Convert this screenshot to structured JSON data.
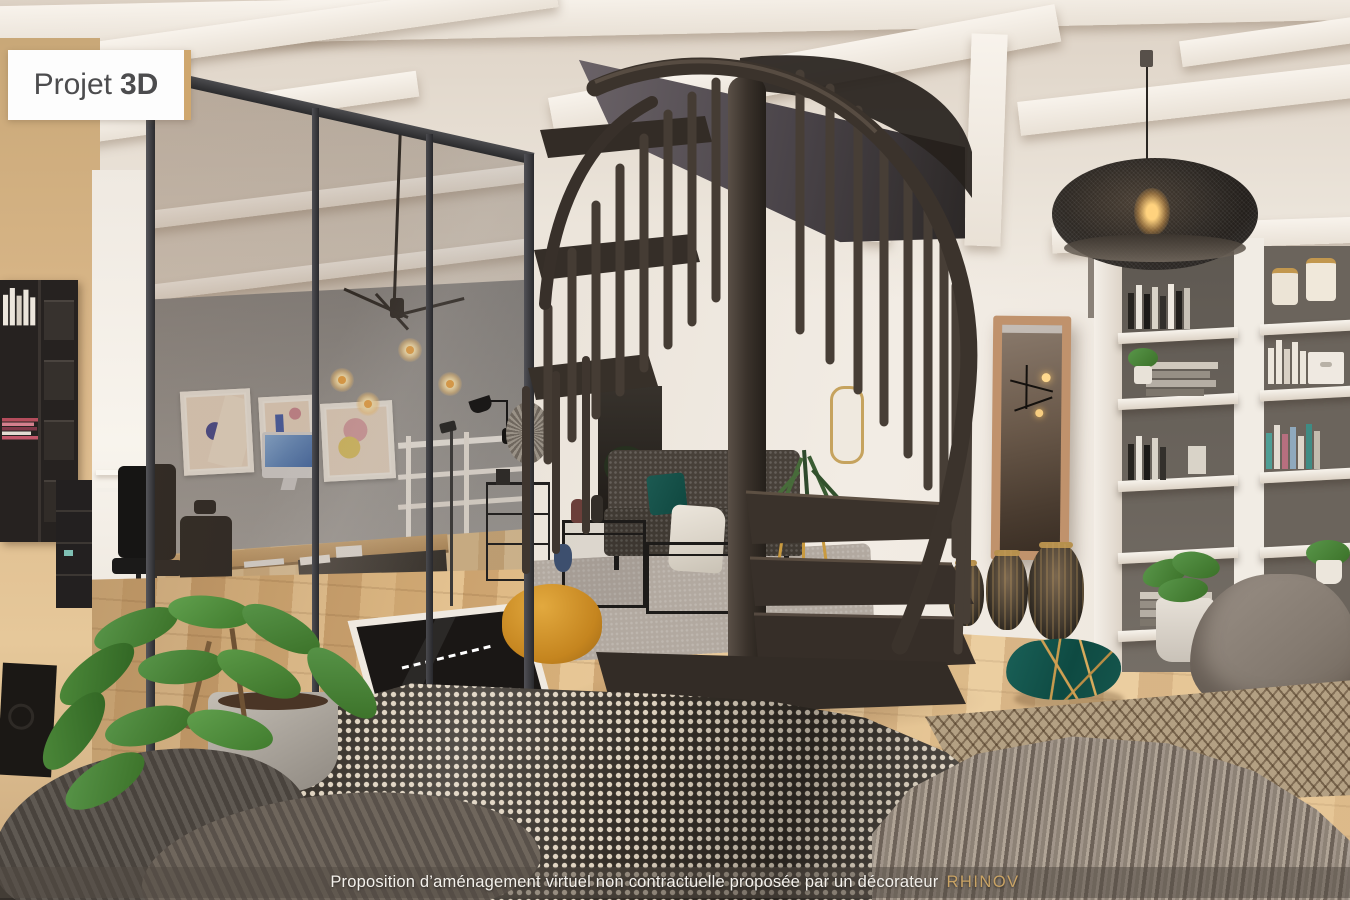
{
  "badge": {
    "regular": "Projet",
    "bold": "3D"
  },
  "caption": {
    "text": "Proposition d’aménagement virtuel non contractuelle proposée par un décorateur",
    "brand": "RHINOV"
  },
  "colors": {
    "wall_cream": "#efe8df",
    "wall_tan": "#dcb98b",
    "partition_frame": "#2e2e30",
    "staircase_metal": "#3a332c",
    "floor_wood": "#dcb483",
    "sofa_gray": "#474039",
    "pouf_mustard": "#d89a35",
    "teal_cushion": "#15564d",
    "accent_gold": "#c9a365",
    "pendant_black": "#221d19",
    "badge_bg": "#ffffff",
    "badge_text": "#4c4c4e",
    "badge_accent": "#cfa76e",
    "caption_bg": "rgba(82,75,68,0.52)"
  }
}
